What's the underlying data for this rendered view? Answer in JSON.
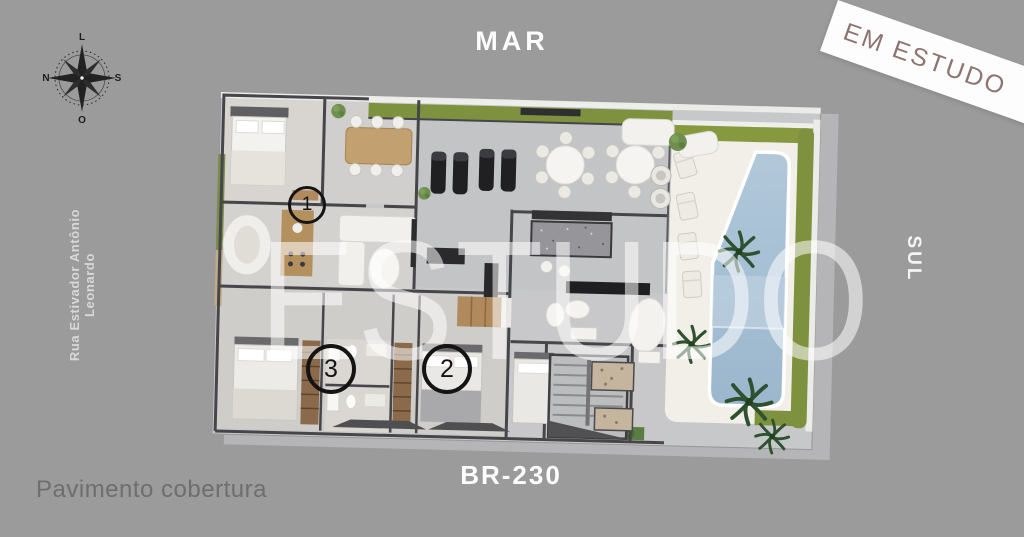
{
  "page": {
    "width": 1024,
    "height": 537,
    "background": "#9b9b9b"
  },
  "labels": {
    "sea": "MAR",
    "south": "SUL",
    "road": "BR-230",
    "street": "Rua Estivador Antônio Leonardo",
    "caption": "Pavimento cobertura",
    "ribbon": "EM ESTUDO",
    "watermark": "ESTUDO"
  },
  "compass": {
    "top": "L",
    "right": "S",
    "bottom": "O",
    "left": "N"
  },
  "units": [
    {
      "number": "1"
    },
    {
      "number": "2"
    },
    {
      "number": "3"
    }
  ],
  "colors": {
    "background": "#9b9b9b",
    "ribbon_bg": "#fdfdfd",
    "ribbon_text": "#8d7470",
    "watermark": "rgba(255,255,255,0.55)",
    "plan_floor": "#c7c8ca",
    "plan_wall": "#46464a",
    "lawn_green": "#7e913f",
    "pool_blue": "#a9c3d8",
    "deck_white": "#f1efe8",
    "caption_text": "#6e6e6e"
  }
}
